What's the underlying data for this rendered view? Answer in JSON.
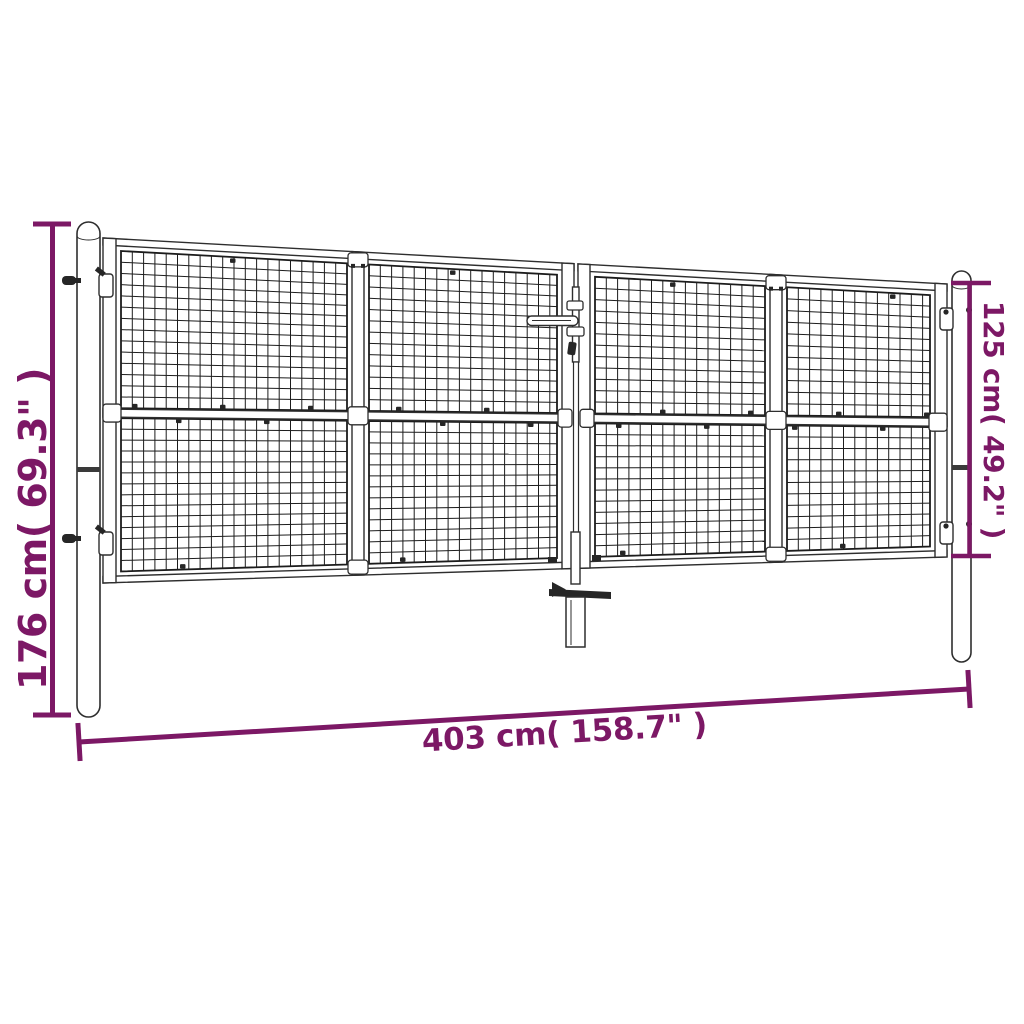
{
  "diagram": {
    "accent_color": "#7C1865",
    "outline_color": "#2e2e2e",
    "mesh_color": "#1c1c1c",
    "dimensions": {
      "post_height": {
        "label": "176 cm( 69.3\" )"
      },
      "gate_height": {
        "label": "125 cm( 49.2\" )"
      },
      "total_width": {
        "label": "403 cm( 158.7\" )"
      }
    }
  }
}
